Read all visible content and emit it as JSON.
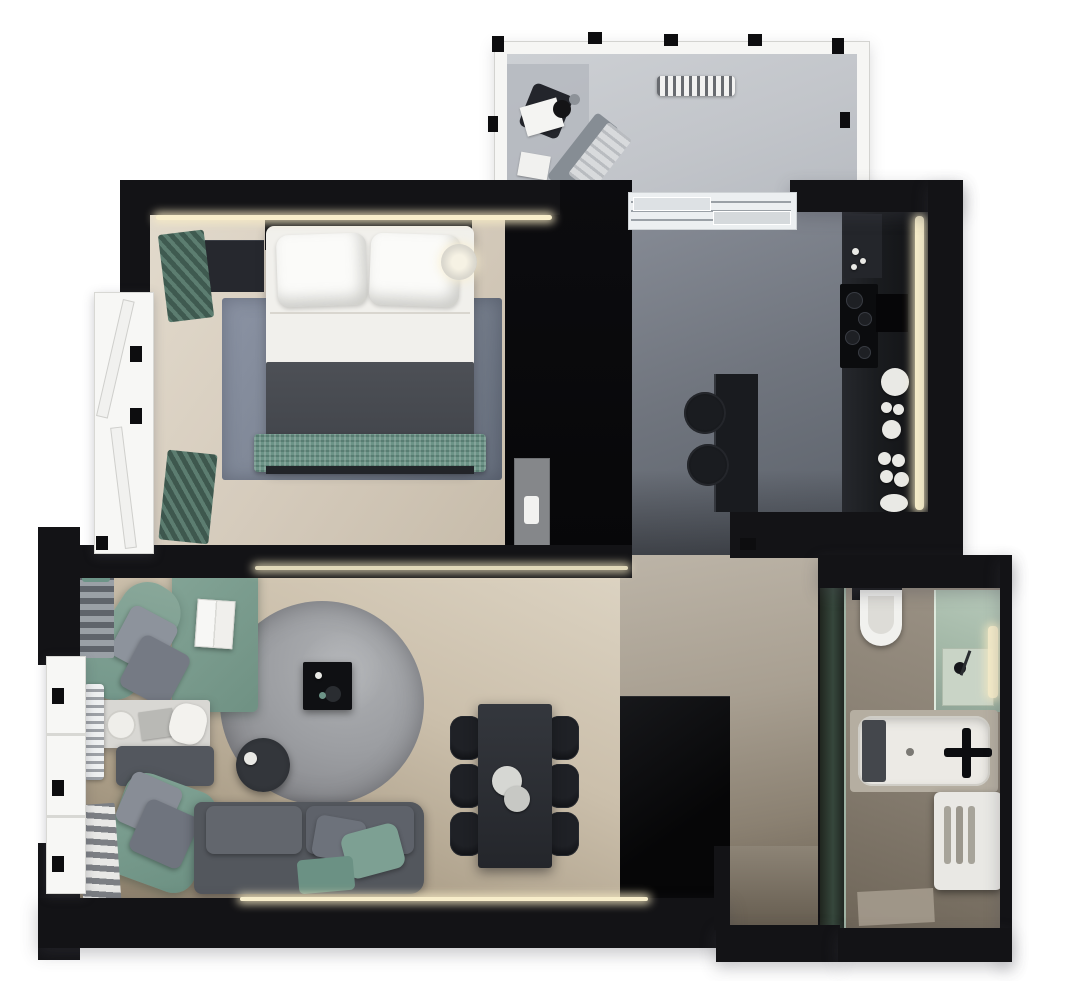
{
  "meta": {
    "kind": "3d-rendered-apartment-floor-plan",
    "view": "top-down",
    "canvas": {
      "width": 1080,
      "height": 981
    },
    "visible_text": "none"
  },
  "palette": {
    "background": "#ffffff",
    "wall_black": "#131316",
    "wood_bedroom": "#d6ccbd",
    "wood_living": "#c3b7a3",
    "tile_hall_upper_gray_marble": "#757b84",
    "tile_hall_lower_beige_marble": "#a2998b",
    "tile_balcony": "#c6c9cd",
    "tile_bathroom": "#8e8579",
    "sofa_green": "#7a9c8f",
    "sofa_gray": "#585c63",
    "bed_blanket_gray": "#45484e",
    "bed_throw_green": "#6c9387",
    "rug_bedroom_blue_gray": "#7e8798",
    "rug_living_round_gray": "#9a9c9f",
    "led_warm_white": "#f8eecb",
    "fixture_white": "#f1f0ec",
    "shower_glass_green": "#aabfae"
  },
  "rooms": [
    {
      "id": "balcony",
      "items": [
        "window-frame",
        "lounge-chair",
        "plant-pot",
        "papers",
        "folded-deck-chair",
        "radiator",
        "sliding-door-threshold"
      ]
    },
    {
      "id": "bedroom",
      "items": [
        "led-cove-light",
        "headboard",
        "dresser",
        "clothes-rack-green-upper",
        "clothes-rack-green-lower",
        "double-bed",
        "pillow",
        "pillow",
        "duvet-gray",
        "throw-green",
        "area-rug",
        "bedside-lamp",
        "wardrobe-black",
        "low-cabinet",
        "french-window"
      ]
    },
    {
      "id": "kitchen",
      "items": [
        "counter-run",
        "upper-unit",
        "cooktop",
        "sink-black",
        "dish-set",
        "led-strip",
        "island",
        "bar-stool",
        "bar-stool"
      ],
      "stool_count": 2
    },
    {
      "id": "hallway-upper",
      "items": [
        "gray-marble-floor"
      ]
    },
    {
      "id": "living-room",
      "items": [
        "green-corner-sofa",
        "cushions",
        "picture-book",
        "white-coffee-table",
        "ottoman-gray",
        "green-chaise",
        "gray-sofa",
        "green-pillows",
        "round-rug",
        "black-coffee-table",
        "round-side-table",
        "ladder-shelf",
        "radiator",
        "magazine-rack",
        "window",
        "led-strip-top",
        "led-strip-bottom"
      ]
    },
    {
      "id": "dining-area",
      "items": [
        "dining-table",
        "dining-chairs",
        "serving-bowls"
      ],
      "chair_count": 6
    },
    {
      "id": "hallway-lower",
      "items": [
        "beige-marble-floor",
        "closet-black",
        "entry-niche"
      ]
    },
    {
      "id": "bathroom",
      "items": [
        "glass-partition-green",
        "wall-hung-toilet",
        "shower-enclosure",
        "shower-head",
        "towel-rail-backlight",
        "bathtub",
        "black-faucet",
        "bath-mat-dark",
        "washing-machine"
      ]
    }
  ]
}
